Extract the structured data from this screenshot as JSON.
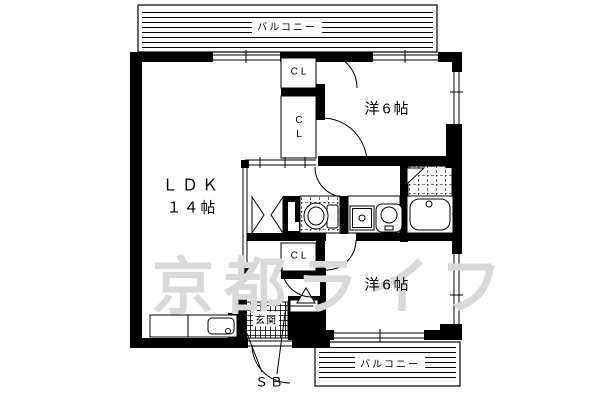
{
  "floor_plan": {
    "balcony_top": {
      "label": "バルコニー"
    },
    "balcony_bottom": {
      "label": "バルコニー"
    },
    "ldk": {
      "name": "ＬＤＫ",
      "size": "１４帖"
    },
    "room_top": {
      "label": "洋6帖"
    },
    "room_bottom": {
      "label": "洋6帖"
    },
    "closet_top": {
      "label": "CL"
    },
    "closet_mid": {
      "line1": "C",
      "line2": "L"
    },
    "closet_bottom": {
      "label": "CL"
    },
    "genkan": {
      "label": "玄関"
    },
    "shoe_box": {
      "label": "ＳＢ"
    },
    "watermark": {
      "text": "京都ライフ",
      "color": "#d9d9d9"
    },
    "colors": {
      "line": "#000000",
      "background": "#ffffff"
    }
  }
}
